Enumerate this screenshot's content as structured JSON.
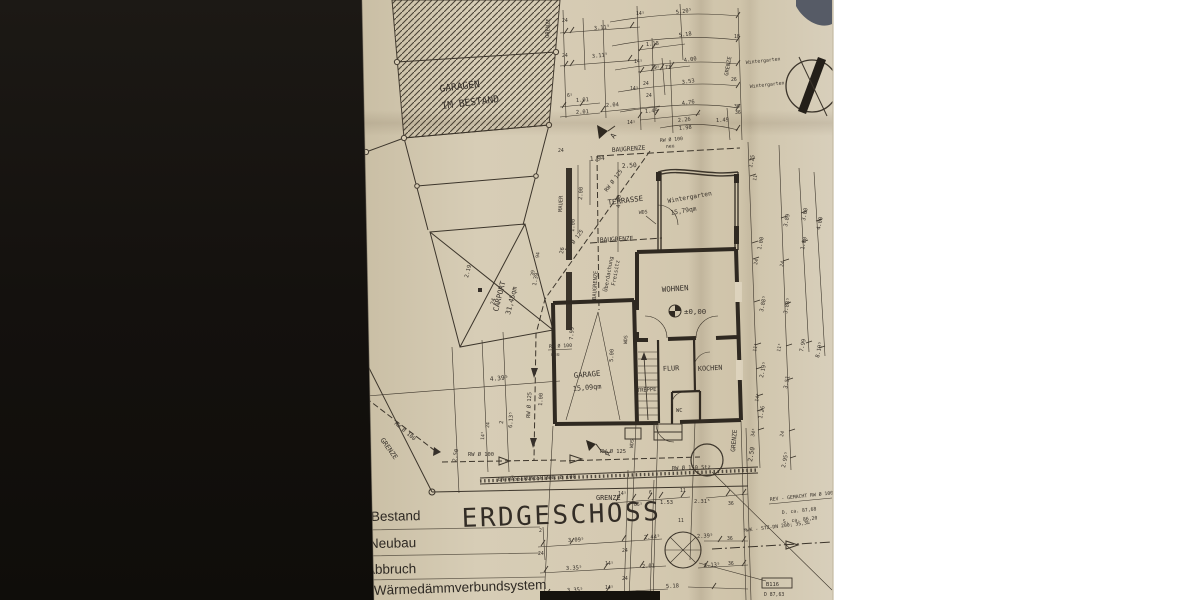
{
  "photo": {
    "background_left_color": "#16130f",
    "background_right_color": "#ffffff",
    "paper_color": "#d3c8af",
    "ink_color": "#3a342b"
  },
  "title": {
    "plan": "ERDGESCHOSS"
  },
  "legend": {
    "items": [
      {
        "label": "Bestand"
      },
      {
        "label": "Neubau"
      },
      {
        "label": "Abbruch"
      },
      {
        "label": "Wärmedämmverbundsystem"
      }
    ]
  },
  "rooms": {
    "garagen_line1": "GARAGEN",
    "garagen_line2": "IM BESTAND",
    "carport_name": "CARPORT",
    "carport_area": "31,45qm",
    "wintergarten_name": "Wintergarten",
    "wintergarten_area": "15,79qm",
    "terrasse": "TERRASSE",
    "wohnen": "WOHNEN",
    "garage_name": "GARAGE",
    "garage_area": "15,09qm",
    "flur": "FLUR",
    "treppe": "TREPPE",
    "kochen": "KOCHEN",
    "wc": "WC",
    "freisitz_line1": "Überdachung",
    "freisitz_line2": "Freisitz",
    "level": "±0,00"
  },
  "boundaries": {
    "grenze": "GRENZE",
    "baugrenze": "BAUGRENZE",
    "mauer": "MAUER"
  },
  "annotations": {
    "wds": "WDS",
    "section": "A",
    "rw100": "RW Ø 100",
    "rw125": "RW Ø 125",
    "rw150": "RW Ø 150 Stz",
    "neu": "neu",
    "rinne": "ENTWÄSSERUNGSRINNE Ø 100",
    "wintergarten_small": "Wintergarten",
    "rev_note": "REV - GEMACHT RW Ø 100 neu",
    "d_ca": "D. ca. 87,68",
    "s_ca": "S. ca. 86,20",
    "mwk": "MwK - STZ-DN 200; 35,3‰",
    "shaft_id": "B116",
    "shaft_d": "D 87,63",
    "shaft_s": "S 86,72"
  },
  "dims": {
    "t": [
      "24",
      "3.11⁵",
      "24",
      "3.11⁵",
      "14⁵",
      "1.18",
      "14⁵",
      "79⁵",
      "71",
      "24",
      "14⁵",
      "6⁵",
      "1.01",
      "2.01",
      "2.04",
      "1.49",
      "14⁵",
      "24",
      "2.26",
      "1.98",
      "1.49",
      "36"
    ],
    "c": [
      "5.20⁵",
      "5.18",
      "4.00",
      "3.53",
      "4.76"
    ],
    "rt": [
      "18",
      "26",
      "36"
    ],
    "ul": [
      "24",
      "1.94",
      "2.50",
      "2.00",
      "4.00",
      "1.00",
      "94",
      "39"
    ],
    "cp": [
      "2.19",
      "24",
      "1.39",
      "26"
    ],
    "ll": [
      "4.39⁵",
      "2",
      "6.13⁵",
      "24",
      "14⁵",
      "1.00",
      "2.50"
    ],
    "g": [
      "7.99",
      "5.00"
    ],
    "rc": [
      "1.25",
      "11",
      "1.00",
      "24",
      "3.88⁵",
      "3.89",
      "24",
      "3.88⁵",
      "11⁵",
      "2.19⁵",
      "14⁵",
      "1.26",
      "34⁵",
      "11⁵",
      "3.51",
      "24",
      "2.95⁵",
      "3.00",
      "1.00",
      "7.99",
      "4.00",
      "8.19⁵",
      "2.50"
    ],
    "b1": [
      "14⁵",
      "85⁵",
      "6",
      "1.53",
      "11",
      "2.31⁵",
      "36"
    ],
    "b2": [
      "2",
      "24",
      "3.09⁵",
      "24",
      "2.44⁵",
      "11",
      "2.39⁵",
      "36"
    ],
    "b3": [
      "3.35⁵",
      "14⁵",
      "24",
      "2.01",
      "1.13⁵",
      "36"
    ],
    "b4": [
      "3.35⁵",
      "14⁵",
      "5.18"
    ],
    "b5": [
      "3.35⁵"
    ]
  }
}
